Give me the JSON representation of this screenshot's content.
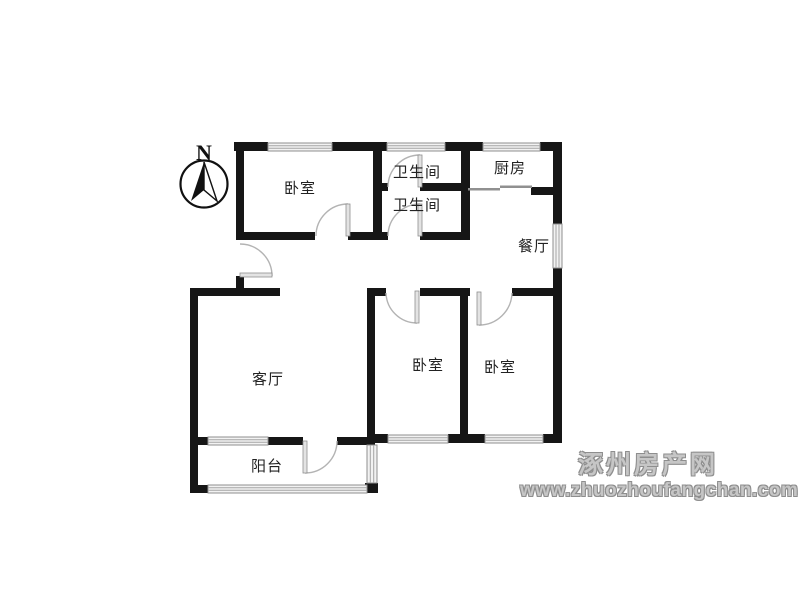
{
  "compass": {
    "label": "N"
  },
  "rooms": {
    "bedroom_top": "卧室",
    "bathroom_upper": "卫生间",
    "bathroom_lower": "卫生间",
    "kitchen": "厨房",
    "dining": "餐厅",
    "living": "客厅",
    "bedroom_mid": "卧室",
    "bedroom_right": "卧室",
    "balcony": "阳台"
  },
  "watermark": {
    "site_name": "涿州房产网",
    "site_url": "www.zhuozhoufangchan.com"
  },
  "colors": {
    "wall": "#161616",
    "window_frame": "#8f8f8f",
    "door_arc": "#b3b3b3",
    "watermark_gray": "#8e8e8e",
    "background": "#ffffff"
  }
}
